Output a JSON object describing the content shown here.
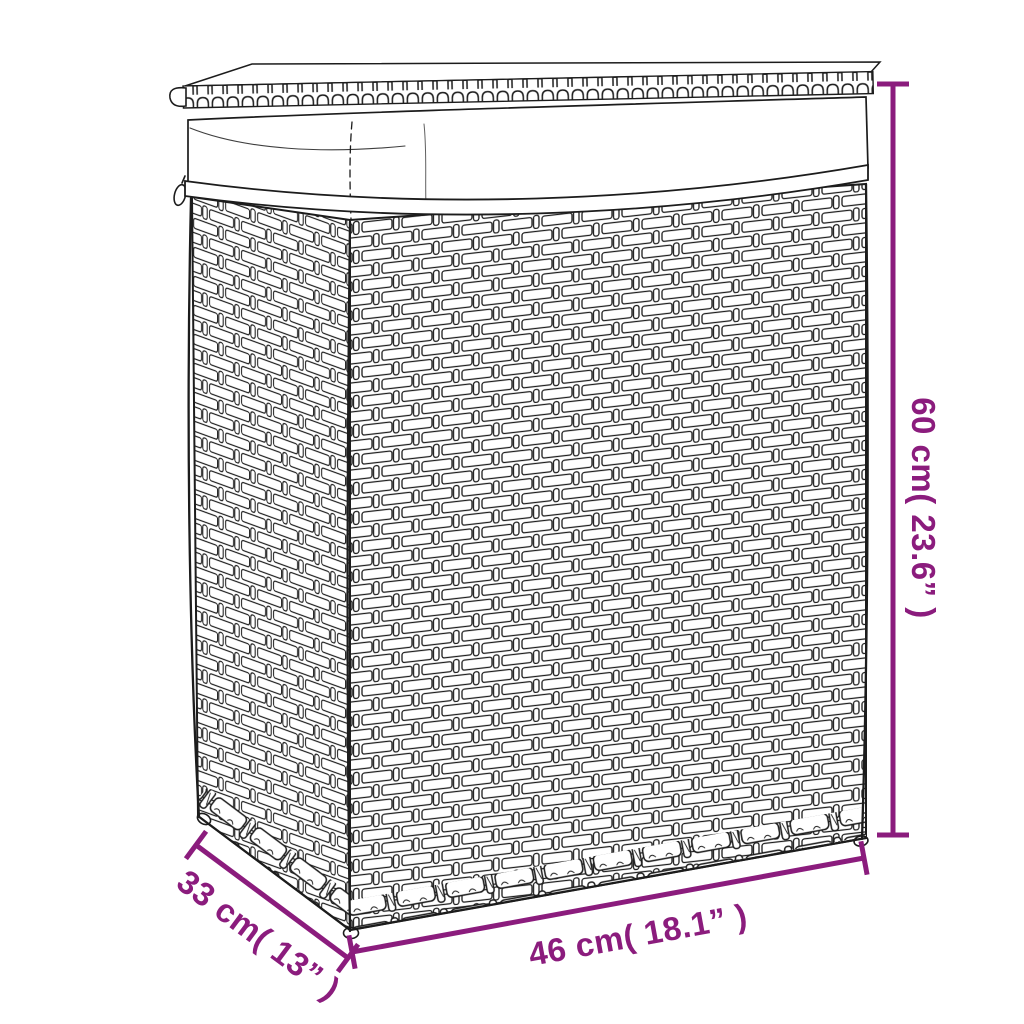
{
  "colors": {
    "accent": "#8b1c7d",
    "ink": "#1c1c1c",
    "background": "#ffffff"
  },
  "illustration": {
    "subject": "Rattan laundry basket with woven lid and white fabric liner",
    "style": "black outline line-art, three-quarter perspective view"
  },
  "dimensions": {
    "height": {
      "cm": 60,
      "inches": 23.6,
      "label": "60 cm( 23.6” )"
    },
    "width": {
      "cm": 46,
      "inches": 18.1,
      "label": "46 cm( 18.1” )"
    },
    "depth": {
      "cm": 33,
      "inches": 13,
      "label": "33 cm( 13” )"
    }
  }
}
